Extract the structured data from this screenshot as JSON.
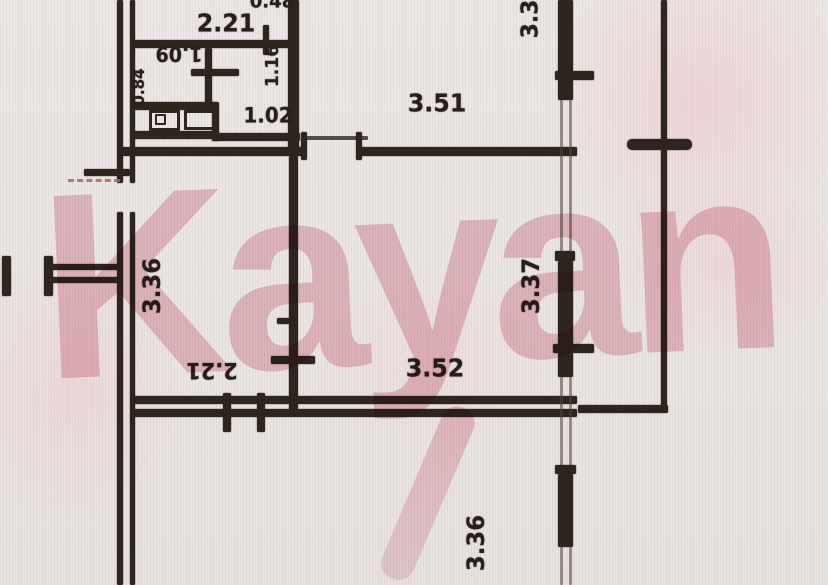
{
  "document": {
    "kind": "apartment-floor-plan-scan"
  },
  "watermark": {
    "text": "Kayan",
    "color": "#df93a4"
  },
  "labels": [
    {
      "name": "dim-0-48-top",
      "text": "0.48",
      "x": 272,
      "y": 2,
      "rot": 0,
      "size": 19
    },
    {
      "name": "dim-2-21-top",
      "text": "2.21",
      "x": 226,
      "y": 23,
      "rot": 0,
      "size": 25
    },
    {
      "name": "dim-1-09-wc",
      "text": "1.09",
      "x": 179,
      "y": 54,
      "rot": 180,
      "size": 20
    },
    {
      "name": "dim-0-84-left",
      "text": "0.84",
      "x": 139,
      "y": 87,
      "rot": -90,
      "size": 16
    },
    {
      "name": "dim-1-16-right",
      "text": "1.16",
      "x": 273,
      "y": 66,
      "rot": -90,
      "size": 18
    },
    {
      "name": "dim-1-02",
      "text": "1.02",
      "x": 268,
      "y": 116,
      "rot": 0,
      "size": 21
    },
    {
      "name": "dim-3-51",
      "text": "3.51",
      "x": 437,
      "y": 103,
      "rot": 0,
      "size": 25
    },
    {
      "name": "dim-3-3-topright",
      "text": "3.3",
      "x": 531,
      "y": 19,
      "rot": -90,
      "size": 23
    },
    {
      "name": "dim-3-36-left",
      "text": "3.36",
      "x": 152,
      "y": 286,
      "rot": -90,
      "size": 24
    },
    {
      "name": "dim-3-37-right",
      "text": "3.37",
      "x": 531,
      "y": 286,
      "rot": -90,
      "size": 24
    },
    {
      "name": "dim-2-21-flipped",
      "text": "2.21",
      "x": 212,
      "y": 369,
      "rot": 180,
      "size": 22
    },
    {
      "name": "dim-3-52",
      "text": "3.52",
      "x": 435,
      "y": 368,
      "rot": 0,
      "size": 25
    },
    {
      "name": "dim-3-36-bottom",
      "text": "3.36",
      "x": 476,
      "y": 543,
      "rot": -90,
      "size": 24
    }
  ]
}
